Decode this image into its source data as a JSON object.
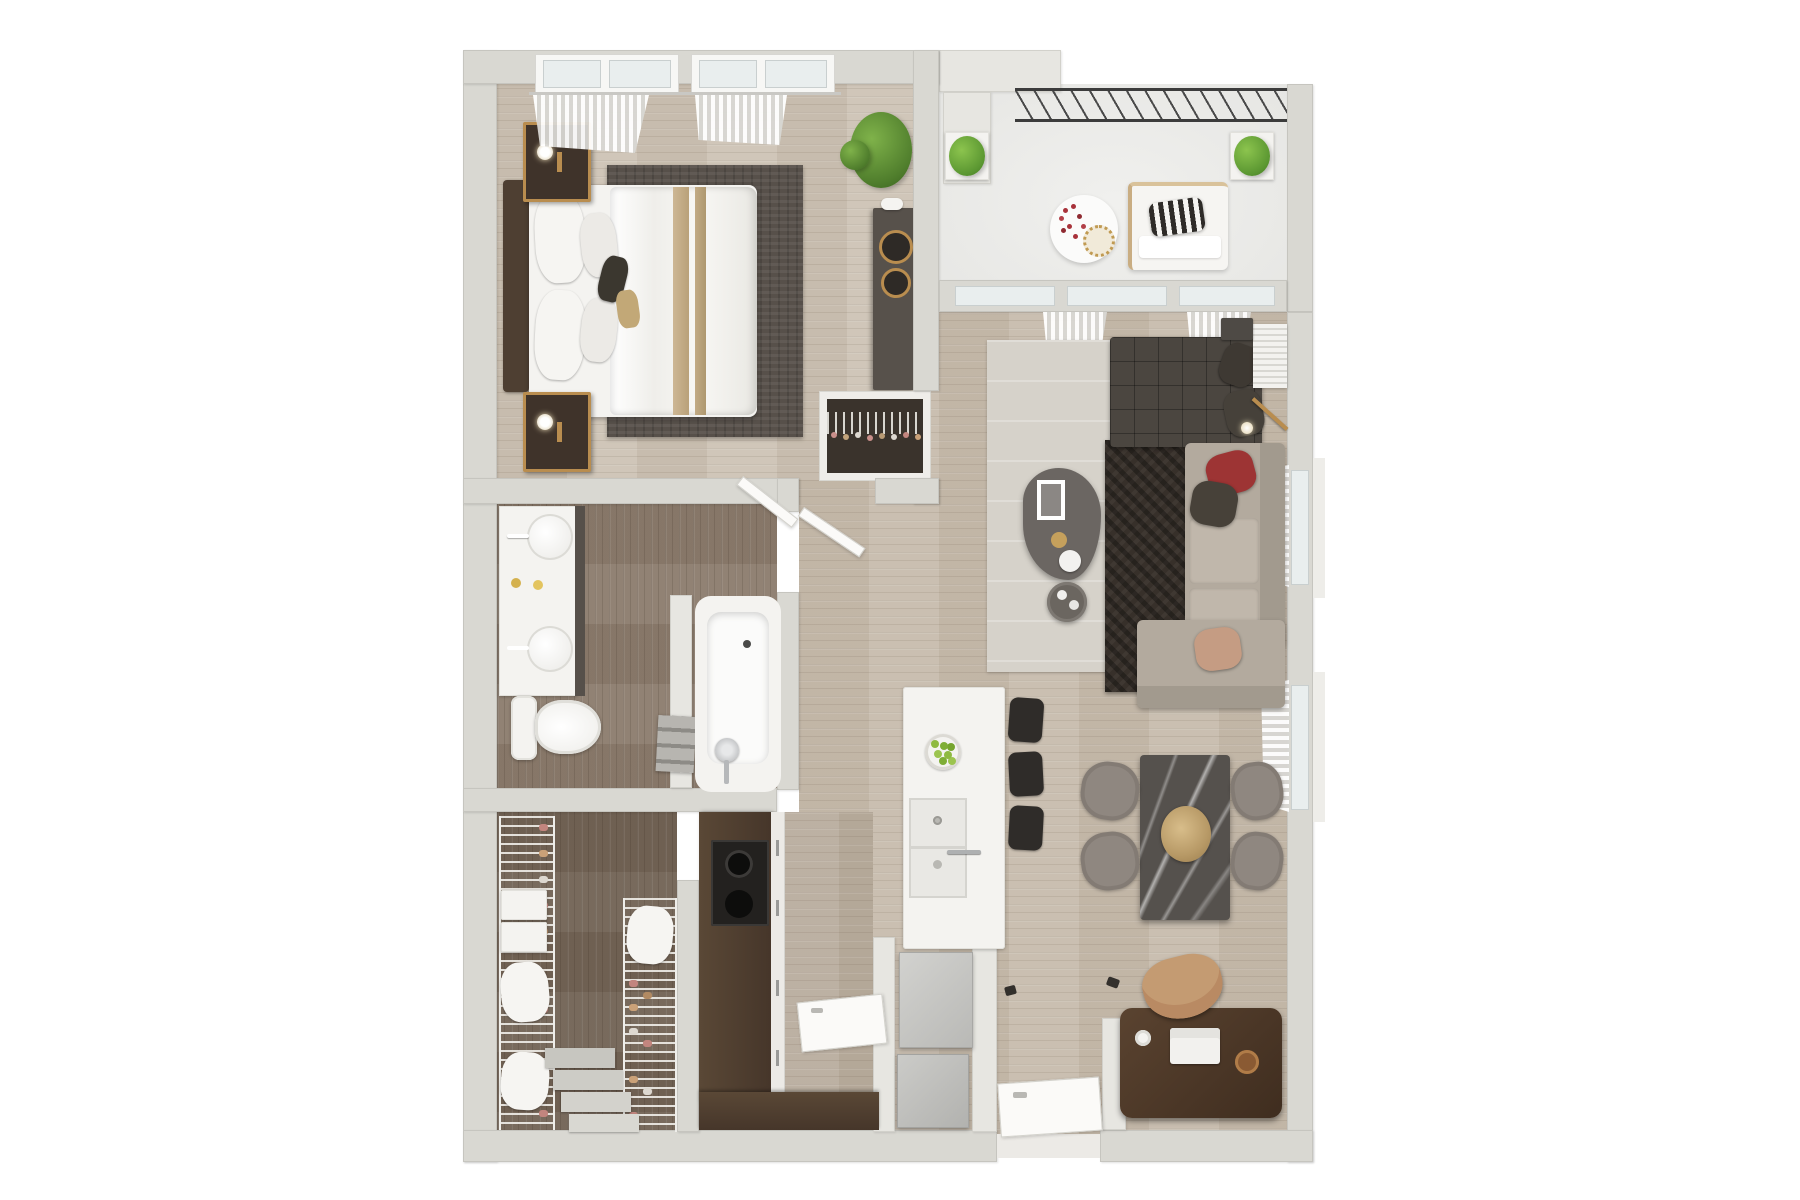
{
  "title": "3D rendered one-bedroom apartment floor plan, top-down view",
  "palette": {
    "background": "#ffffff",
    "walls": "#d9d8d2",
    "wood_floor": "#c7bcad",
    "dark_wood_floor": "#7a6b5d",
    "balcony_floor": "#ebebe9",
    "accent_gold": "#b98d4f",
    "sofa_red_pillow": "#9d3434",
    "plant_green": "#5d8f3a",
    "counter_brown": "#51402f",
    "charcoal_furniture": "#4b4640"
  },
  "rooms": {
    "bedroom": {
      "label": "Bedroom",
      "furniture": [
        "double bed with white bedding and gold throw",
        "upholstered headboard",
        "two brass nightstands with lamps",
        "dark gray area rug",
        "potted plant",
        "dark dresser with brass trays",
        "reach-in closet with hangers",
        "windows with sheer curtains"
      ]
    },
    "balcony": {
      "label": "Balcony",
      "furniture": [
        "metal railing",
        "white lounge bench with striped pillow",
        "round side table with red flowers",
        "two boxwood planters"
      ]
    },
    "living_room": {
      "label": "Living room",
      "furniture": [
        "dark tufted chaise with pillows",
        "beige L-sectional sofa with red, charcoal and blush pillows",
        "dark shag rug",
        "light area rug",
        "organic-shaped coffee table with tray and candles",
        "round side tray table",
        "brass floor lamp",
        "slatted side table",
        "sheer curtains at windows"
      ]
    },
    "dining_area": {
      "label": "Dining area",
      "furniture": [
        "dark marble dining table",
        "four taupe chairs",
        "dried flower centerpiece"
      ]
    },
    "kitchen": {
      "label": "Kitchen",
      "furniture": [
        "white island with double sink and bowl of green apples",
        "three black bar stools",
        "dark wood counter with two-burner stove",
        "refrigerator",
        "washer"
      ]
    },
    "bathroom": {
      "label": "Bathroom",
      "furniture": [
        "double vanity with round sinks and gold soap dishes",
        "toilet",
        "freestanding bathtub with chrome faucet",
        "towel shelf"
      ]
    },
    "walk_in_closet": {
      "label": "Walk-in closet",
      "furniture": [
        "wire shelving with shoes",
        "storage boxes",
        "white cushions",
        "step shoe risers"
      ]
    },
    "entry": {
      "label": "Entry",
      "furniture": [
        "open entry door"
      ]
    },
    "office_nook": {
      "label": "Office nook",
      "furniture": [
        "dark wood desk with laptop and cup",
        "tan desk chair",
        "partition wall"
      ]
    }
  }
}
